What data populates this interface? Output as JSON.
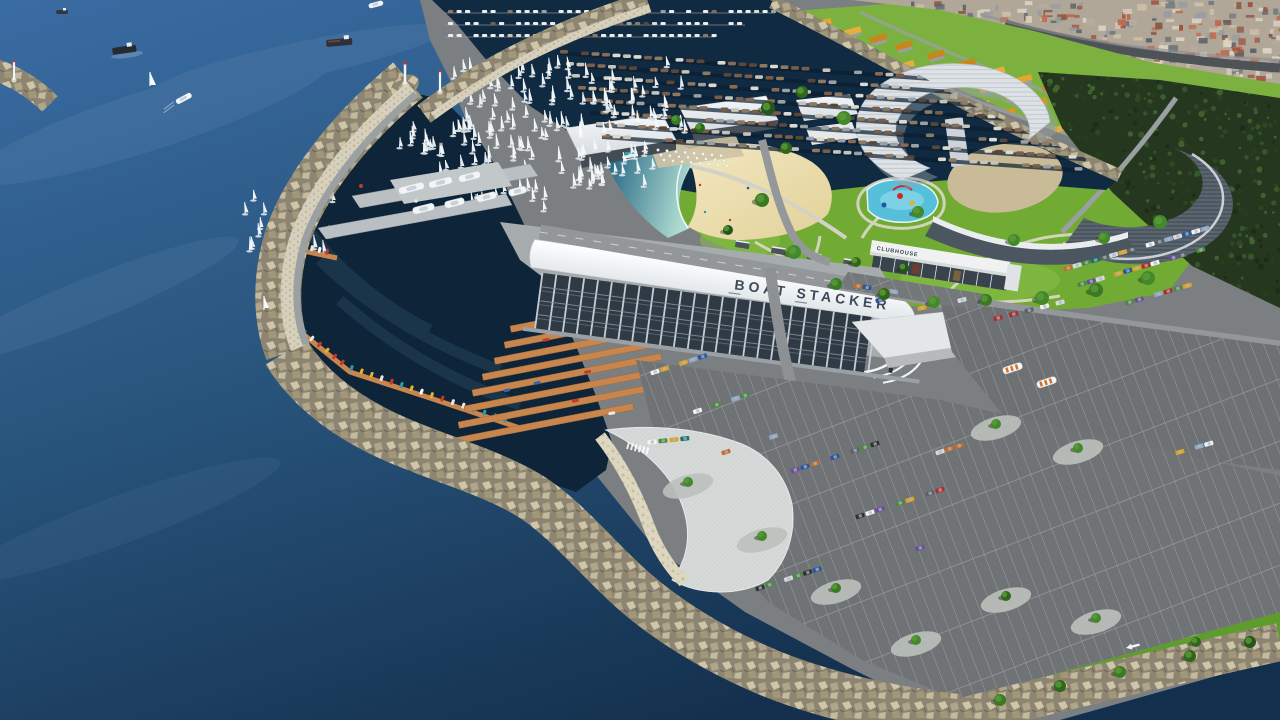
{
  "scene": {
    "kind": "aerial-3d-architectural-render",
    "title": "Marina development aerial rendering",
    "labels": {
      "boat_stacker": "BOAT STACKER",
      "clubhouse": "CLUBHOUSE"
    },
    "palette": {
      "sea_top": "#38699f",
      "sea_mid": "#27537f",
      "sea_deep": "#122c49",
      "harbor": "#0e2438",
      "basin": "#102a42",
      "lagoon_deep": "#1f607f",
      "lagoon_shallow": "#aedbd2",
      "sand": "#ecdfad",
      "grass": "#72ab33",
      "grass_light": "#8cc24b",
      "rock_base": "#8d8571",
      "rock_light": "#cfc5a9",
      "armor_concrete": "#d6d0bc",
      "asphalt": "#6f7275",
      "road": "#95989b",
      "plaza": "#d2d6d4",
      "dock_wood": "#c8854d",
      "pier_concrete": "#b9bfc2",
      "roof_white": "#eef1f3",
      "steel": "#8d98a4",
      "interior_dark": "#2f3a45",
      "roof_orange": "#d7961d",
      "forest": "#25381f",
      "pool_blue": "#56c0da",
      "label_dark": "#3d4a59"
    },
    "generated": {
      "car_colors": [
        "#f2f4f5",
        "#d8dbdd",
        "#2c3135",
        "#5a6167",
        "#b02b2b",
        "#2456a2",
        "#e0a021",
        "#4a8b3b",
        "#6b4b9b",
        "#c56b2b",
        "#8fa8c8",
        "#1d6f6f"
      ],
      "boat_hull_colors": [
        "#7a5c49",
        "#8a6a52",
        "#9aa0a4",
        "#ded9d0",
        "#5c4636",
        "#8c7a62",
        "#c8c3b8"
      ],
      "dinghy_colors": [
        "#e8e8e8",
        "#c23a2a",
        "#2a9aa8",
        "#e2b32a",
        "#3a62a8",
        "#ffffff"
      ],
      "roof_tones": [
        "#d7961d",
        "#e2a72c",
        "#c8871a",
        "#e6ae3a"
      ],
      "city_tones": [
        "#c06a4e",
        "#d9d0c2",
        "#979da2",
        "#b6ac9e",
        "#e0d8c6",
        "#a05540",
        "#70767c",
        "#cdbfa8",
        "#8a5a46",
        "#5d646a"
      ],
      "forest_tones": [
        "#2f4a26",
        "#1d2b17",
        "#3a5c2d",
        "#24401e",
        "#466b33"
      ],
      "tree_greens": [
        "#2e661c",
        "#3a7a24",
        "#27541a",
        "#43882b"
      ],
      "sail_white": "#f6fafc",
      "counts": {
        "city_blocks": 420,
        "forest_dots": 520
      }
    }
  }
}
